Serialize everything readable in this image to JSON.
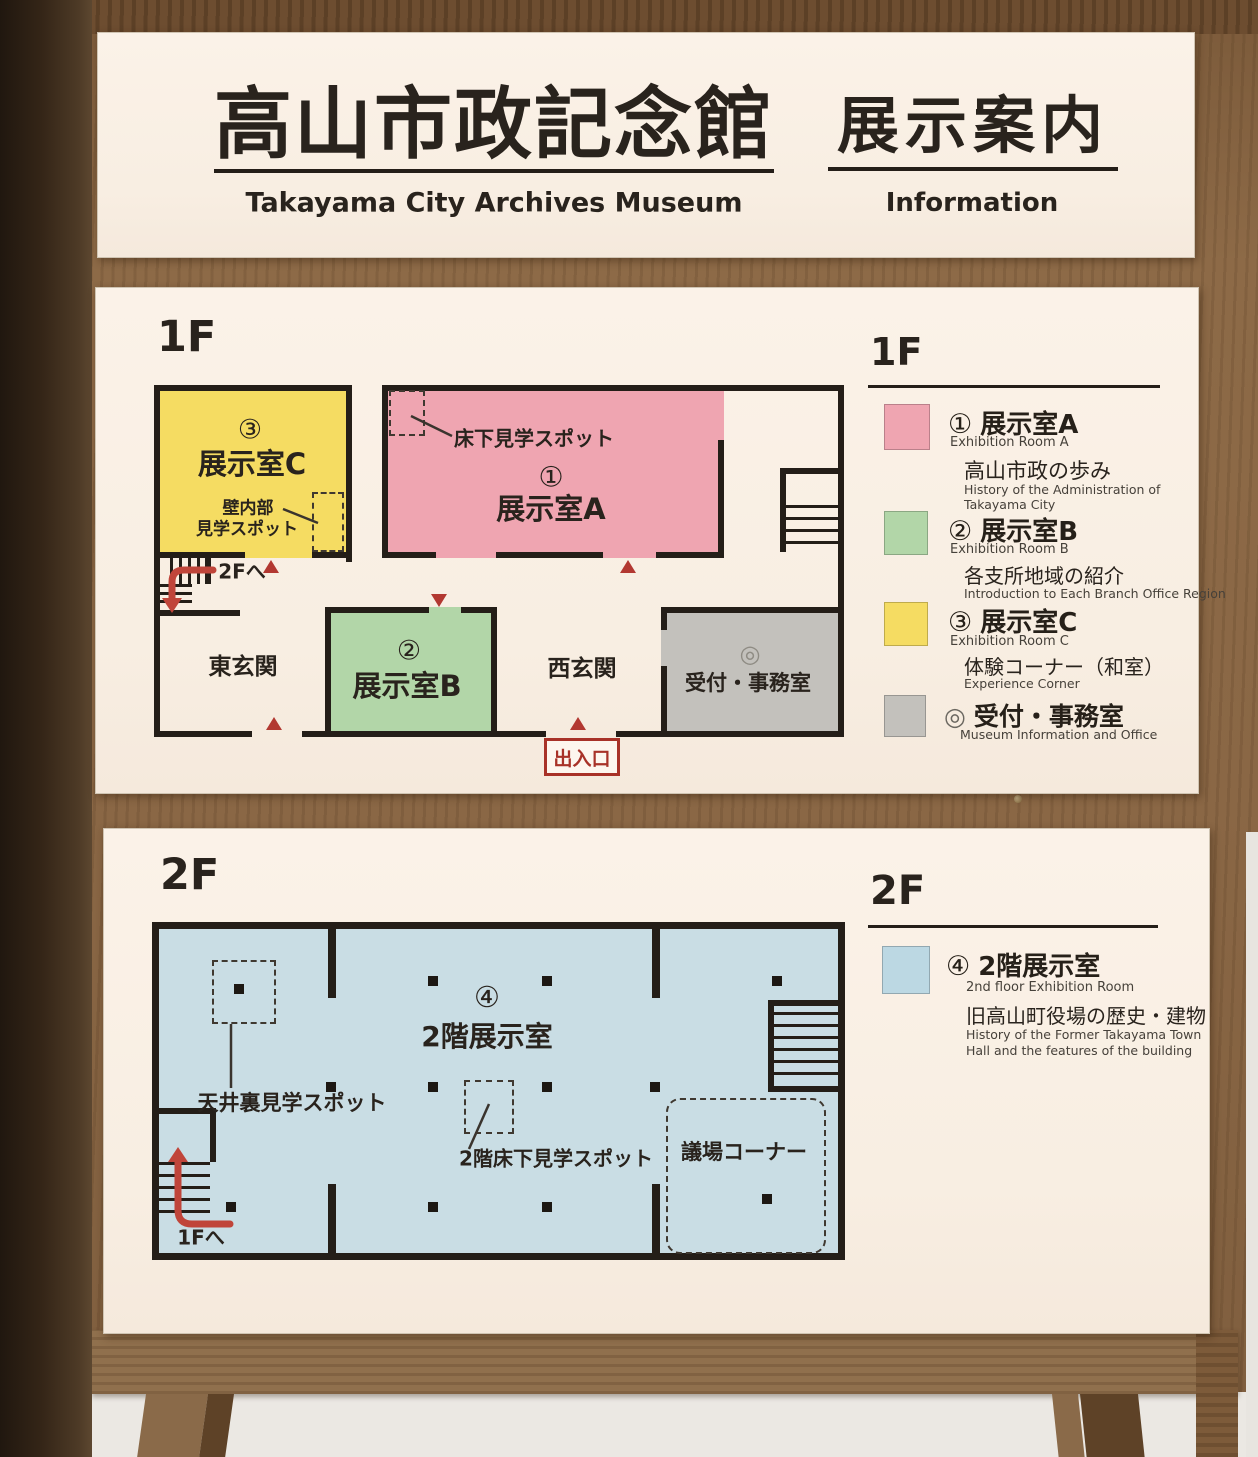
{
  "colors": {
    "panel_cream": "#f9efe4",
    "wood": "#8a6747",
    "line_black": "#241e18",
    "accent_red": "#b23831",
    "room_a_pink": "#efa5b1",
    "room_b_green": "#b2d6a8",
    "room_c_yellow": "#f5dc62",
    "reception_gray": "#c3c1bc",
    "floor2_blue": "#c9dde4"
  },
  "sign": {
    "title_jp": "高山市政記念館",
    "title_en": "Takayama City Archives Museum",
    "info_jp": "展示案内",
    "info_en": "Information"
  },
  "floor1": {
    "label": "1F",
    "plan": {
      "room_a_number": "①",
      "room_a_name": "展示室A",
      "room_b_number": "②",
      "room_b_name": "展示室B",
      "room_c_number": "③",
      "room_c_name": "展示室C",
      "underfloor_spot": "床下見学スポット",
      "wall_spot_line1": "壁内部",
      "wall_spot_line2": "見学スポット",
      "to_2f": "2Fへ",
      "east_entrance": "東玄関",
      "west_entrance": "西玄関",
      "reception_symbol": "◎",
      "reception_name": "受付・事務室",
      "doorway": "出入口"
    },
    "legend": {
      "heading": "1F",
      "items": [
        {
          "number": "①",
          "name_jp": "展示室A",
          "name_en": "Exhibition Room A",
          "desc_jp": "高山市政の歩み",
          "desc_en_1": "History of the Administration of",
          "desc_en_2": "Takayama City",
          "color": "#efa5b1"
        },
        {
          "number": "②",
          "name_jp": "展示室B",
          "name_en": "Exhibition Room B",
          "desc_jp": "各支所地域の紹介",
          "desc_en_1": "Introduction to Each Branch Office Region",
          "color": "#b2d6a8"
        },
        {
          "number": "③",
          "name_jp": "展示室C",
          "name_en": "Exhibition Room C",
          "desc_jp": "体験コーナー（和室）",
          "desc_en_1": "Experience Corner",
          "color": "#f5dc62"
        },
        {
          "symbol": "◎",
          "name_jp": "受付・事務室",
          "name_en": "Museum Information and Office",
          "color": "#c3c1bc"
        }
      ]
    }
  },
  "floor2": {
    "label": "2F",
    "plan": {
      "room_number": "④",
      "room_name": "2階展示室",
      "ceiling_spot": "天井裏見学スポット",
      "underfloor_spot": "2階床下見学スポット",
      "assembly_corner": "議場コーナー",
      "to_1f": "1Fへ"
    },
    "legend": {
      "heading": "2F",
      "item": {
        "number": "④",
        "name_jp": "2階展示室",
        "name_en": "2nd floor Exhibition Room",
        "desc_jp": "旧高山町役場の歴史・建物",
        "desc_en_1": "History of the Former Takayama Town",
        "desc_en_2": "Hall and the features of the building",
        "color": "#c9dde4"
      }
    }
  }
}
